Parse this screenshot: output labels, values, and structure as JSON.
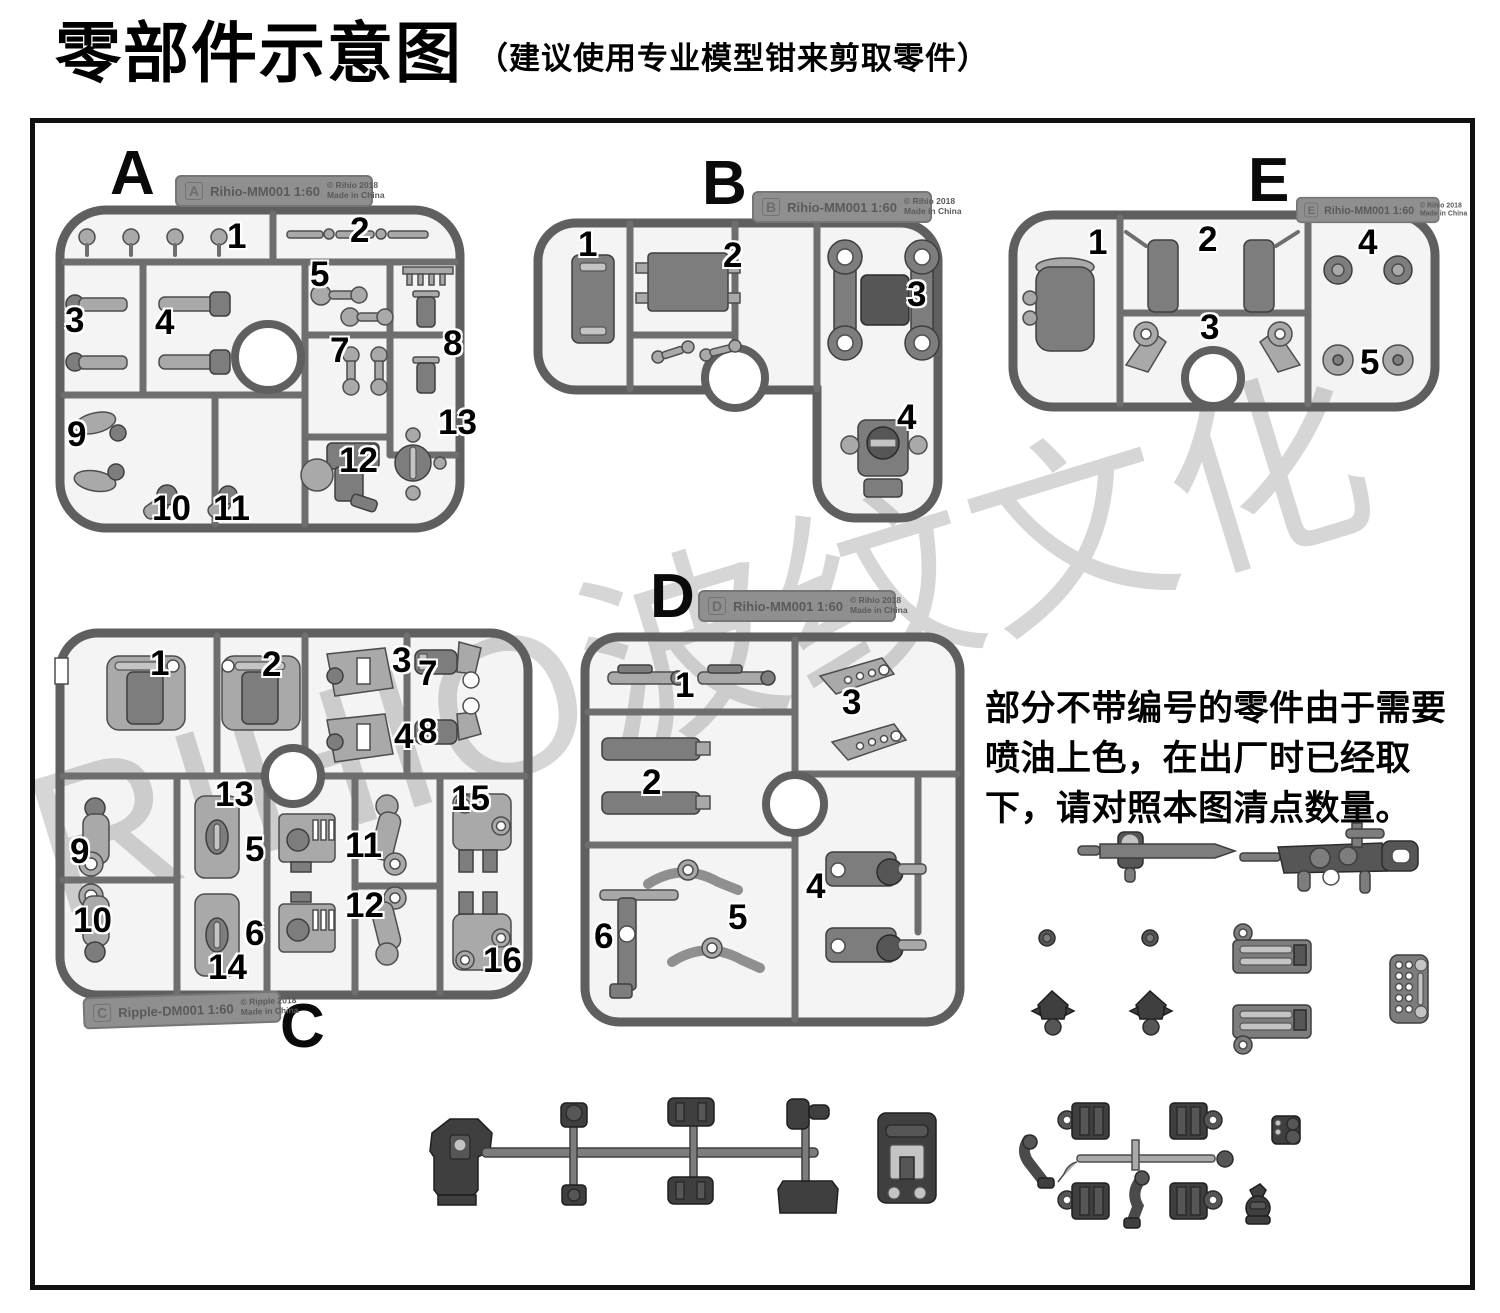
{
  "page": {
    "title": "零部件示意图",
    "subtitle": "（建议使用专业模型钳来剪取零件）"
  },
  "note": {
    "text": "部分不带编号的零件由于需要喷油上色，在出厂时已经取下，请对照本图清点数量。"
  },
  "watermark": {
    "text": "RIHIO波纹文化"
  },
  "colors": {
    "runner": "#5f5f5f",
    "part": "#a9a9a9",
    "dark": "#3f3f3f",
    "wm": "#d6d6d6"
  },
  "sprues": {
    "a": {
      "letter": "A",
      "tab_letter": "A",
      "code": "Rihio-MM001 1:60",
      "copyright": "© Rihio 2018",
      "origin": "Made in China",
      "parts": [
        "1",
        "2",
        "3",
        "4",
        "5",
        "7",
        "8",
        "9",
        "10",
        "11",
        "12",
        "13"
      ]
    },
    "b": {
      "letter": "B",
      "tab_letter": "B",
      "code": "Rihio-MM001 1:60",
      "copyright": "© Rihio 2018",
      "origin": "Made in China",
      "parts": [
        "1",
        "2",
        "3",
        "4"
      ]
    },
    "e": {
      "letter": "E",
      "tab_letter": "E",
      "code": "Rihio-MM001 1:60",
      "copyright": "© Rihio 2018",
      "origin": "Made in China",
      "parts": [
        "1",
        "2",
        "3",
        "4",
        "5"
      ]
    },
    "c": {
      "letter": "C",
      "tab_letter": "C",
      "code": "Ripple-DM001 1:60",
      "copyright": "© Ripple 2018",
      "origin": "Made in China",
      "parts": [
        "1",
        "2",
        "3",
        "4",
        "5",
        "6",
        "7",
        "8",
        "9",
        "10",
        "11",
        "12",
        "13",
        "14",
        "15",
        "16"
      ]
    },
    "d": {
      "letter": "D",
      "tab_letter": "D",
      "code": "Rihio-MM001 1:60",
      "copyright": "© Rihio 2018",
      "origin": "Made in China",
      "parts": [
        "1",
        "2",
        "3",
        "4",
        "5",
        "6"
      ]
    }
  }
}
